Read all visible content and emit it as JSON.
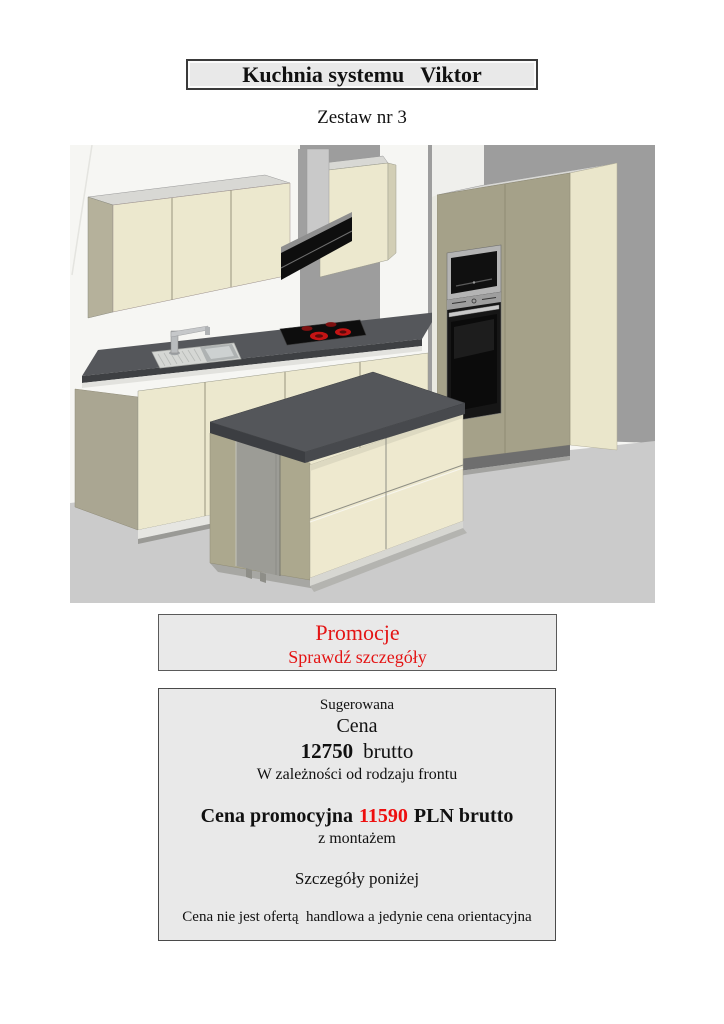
{
  "document": {
    "title": "Kuchnia systemu   Viktor",
    "subtitle": "Zestaw nr 3"
  },
  "promo_box": {
    "heading": "Promocje",
    "subheading": "Sprawdź szczegóły"
  },
  "price_box": {
    "suggested_label": "Sugerowana",
    "price_word": "Cena",
    "suggested_price": "12750",
    "suggested_price_suffix": "brutto",
    "variant_note": "W zależności od rodzaju frontu",
    "promo_price_prefix": "Cena promocyjna",
    "promo_price": "11590",
    "promo_price_suffix": "PLN brutto",
    "installation_note": "z montażem",
    "details_note": "Szczegóły poniżej",
    "disclaimer": "Cena nie jest ofertą  handlowa a jedynie cena orientacyjna"
  },
  "scene": {
    "label": "3D render of Viktor kitchen set nr 3"
  },
  "colors": {
    "accent_red": "#e41414",
    "price_red": "#ee0f0f",
    "box_background": "#e9e9e9",
    "cabinet_cream": "#ece8ce",
    "cabinet_khaki": "#a5a189",
    "countertop_gray": "#55575b",
    "wall_gray": "#9d9d9d",
    "floor_gray": "#cbcbcb"
  }
}
